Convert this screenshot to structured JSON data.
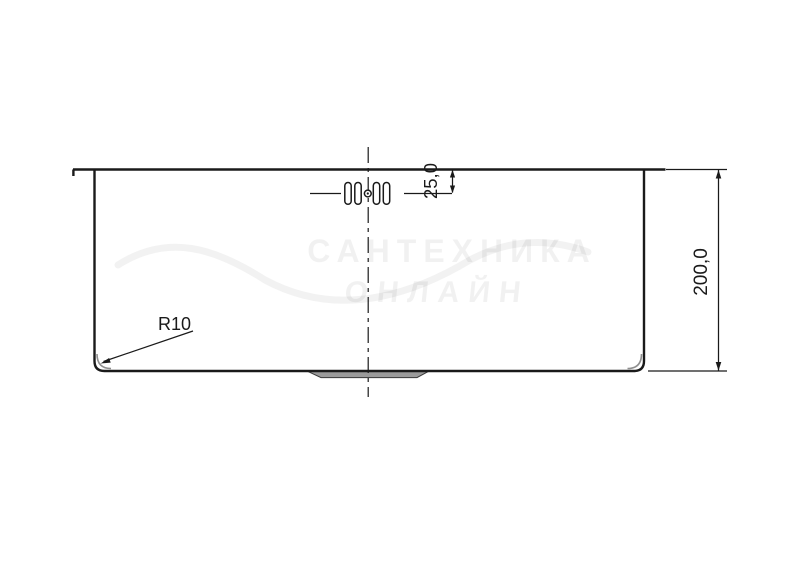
{
  "drawing": {
    "dim_holes_offset": "25,0",
    "dim_depth": "200,0",
    "dim_corner_radius": "R10"
  },
  "watermark": {
    "line1": "САНТЕХНИКА",
    "line2": "ОНЛАЙН"
  },
  "colors": {
    "line": "#1a1a1a",
    "recess_fill": "#9b9b9b",
    "background": "#ffffff"
  }
}
